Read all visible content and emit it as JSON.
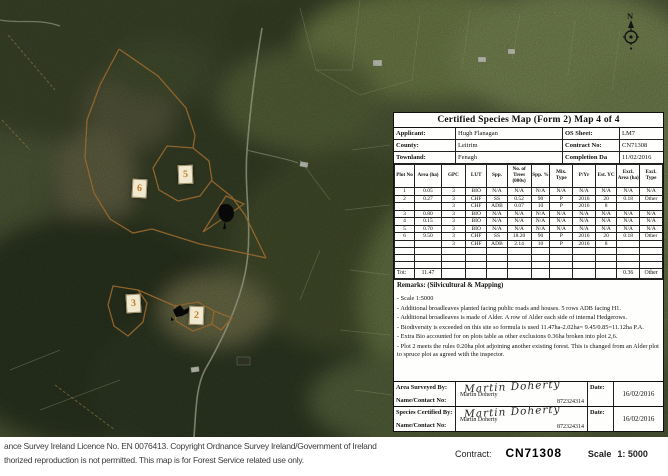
{
  "map": {
    "north_label": "N",
    "plot_markers": [
      {
        "label": "5"
      },
      {
        "label": "6"
      },
      {
        "label": "3"
      },
      {
        "label": "2"
      }
    ],
    "colors": {
      "plot_boundary": "#c98b3e",
      "marker_number": "#c07c28",
      "marker_box": "#f1e8d0"
    }
  },
  "form": {
    "title": "Certified Species Map (Form 2) Map 4 of 4",
    "info": {
      "applicant_label": "Applicant:",
      "applicant": "Hugh Flanagan",
      "county_label": "County:",
      "county": "Leitrim",
      "townland_label": "Townland:",
      "townland": "Fenagh",
      "os_sheet_label": "OS Sheet:",
      "os_sheet": "LM7",
      "contract_label": "Contract No:",
      "contract": "CN71308",
      "completion_label": "Completion Da",
      "completion": "11/02/2016"
    },
    "table": {
      "headers": [
        "Plot No",
        "Area (ha)",
        "GPC",
        "LUT",
        "Spp.",
        "No. of Trees (000s)",
        "Spp. %",
        "Mix. Type",
        "P/Yr",
        "Est. YC",
        "Excl. Area (ha)",
        "Excl. Type"
      ],
      "rows": [
        [
          "1",
          "0.05",
          "3",
          "BIO",
          "N/A",
          "N/A",
          "N/A",
          "N/A",
          "N/A",
          "N/A",
          "N/A",
          "N/A"
        ],
        [
          "2",
          "0.27",
          "3",
          "CHF",
          "SS",
          "0.52",
          "90",
          "P",
          "2016",
          "20",
          "0.18",
          "Other"
        ],
        [
          "",
          "",
          "3",
          "CHF",
          "ADB",
          "0.07",
          "10",
          "P",
          "2016",
          "8",
          "",
          ""
        ],
        [
          "3",
          "0.80",
          "3",
          "BIO",
          "N/A",
          "N/A",
          "N/A",
          "N/A",
          "N/A",
          "N/A",
          "N/A",
          "N/A"
        ],
        [
          "4",
          "0.15",
          "3",
          "BIO",
          "N/A",
          "N/A",
          "N/A",
          "N/A",
          "N/A",
          "N/A",
          "N/A",
          "N/A"
        ],
        [
          "5",
          "0.70",
          "3",
          "BIO",
          "N/A",
          "N/A",
          "N/A",
          "N/A",
          "N/A",
          "N/A",
          "N/A",
          "N/A"
        ],
        [
          "6",
          "9.50",
          "3",
          "CHF",
          "SS",
          "18.20",
          "90",
          "P",
          "2016",
          "20",
          "0.18",
          "Other"
        ],
        [
          "",
          "",
          "3",
          "CHF",
          "ADB",
          "2.14",
          "10",
          "P",
          "2016",
          "8",
          "",
          ""
        ],
        [
          "",
          "",
          "",
          "",
          "",
          "",
          "",
          "",
          "",
          "",
          "",
          ""
        ],
        [
          "",
          "",
          "",
          "",
          "",
          "",
          "",
          "",
          "",
          "",
          "",
          ""
        ],
        [
          "",
          "",
          "",
          "",
          "",
          "",
          "",
          "",
          "",
          "",
          "",
          ""
        ]
      ],
      "total_row": [
        "Tot:",
        "11.47",
        "",
        "",
        "",
        "",
        "",
        "",
        "",
        "",
        "0.36",
        "Other"
      ]
    },
    "remarks": {
      "heading": "Remarks: (Silvicultural & Mapping)",
      "lines": [
        "- Scale 1:5000",
        "- Additional broadleaves planted facing public roads and houses. 5 rows ADB facing H1.",
        "- Additional broadleaves is made of Alder. A row of Alder each side of internal Hedgerows.",
        "- Biodiversity is exceeded on this site so formula is used 11.47ha-2.02ha= 9.45/0.85=11.12ha P.A.",
        "- Extra Bio accounted for on plots table as other exclusions 0.36ha broken into plot 2,6.",
        "- Plot 2 meets the rules 0.20ha plot adjoining another existing forest. This is changed from an Alder plot to spruce plot as agreed with the inspector."
      ]
    },
    "signatures": [
      {
        "role_label": "Area Surveyed By:",
        "contact_label": "Name/Contact No:",
        "signature": "Martin Doherty",
        "printed_name": "Martin Doherty",
        "contact_no": "872324314",
        "date_label": "Date:",
        "date": "16/02/2016"
      },
      {
        "role_label": "Species Certified By:",
        "contact_label": "Name/Contact No:",
        "signature": "Martin Doherty",
        "printed_name": "Martin Doherty",
        "contact_no": "872324314",
        "date_label": "Date:",
        "date": "16/02/2016"
      }
    ],
    "footer": {
      "contract_label": "Contract:",
      "contract_value": "CN71308",
      "scale_label": "Scale",
      "scale_value": "1: 5000"
    }
  },
  "copyright": {
    "line1": "ance Survey Ireland Licence No. EN 0076413. Copyright Ordnance Survey Ireland/Government of Ireland",
    "line2": "thorized reproduction is not permitted. This map is for Forest Service related use only."
  }
}
